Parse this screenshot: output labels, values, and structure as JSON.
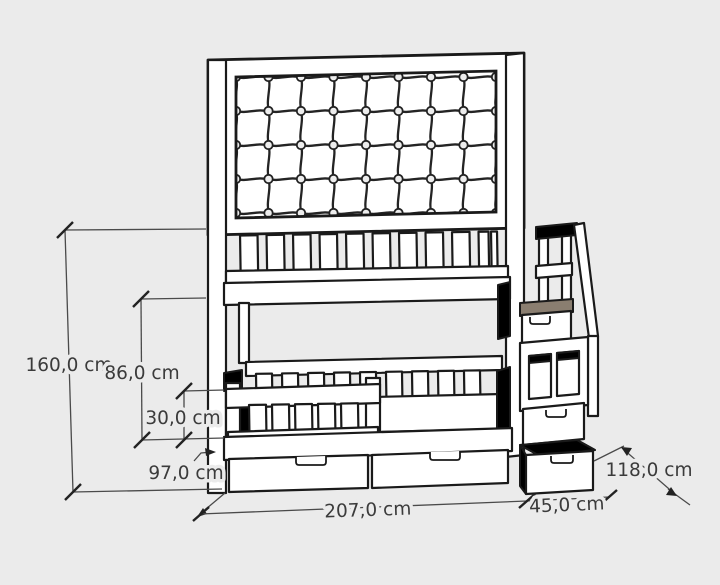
{
  "dims": {
    "total_height": {
      "label": "160,0 cm"
    },
    "upper_bunk_height": {
      "label": "86,0 cm"
    },
    "guardrail_height": {
      "label": "30,0 cm"
    },
    "bed_depth": {
      "label": "97,0 cm"
    },
    "bed_length": {
      "label": "207,0 cm"
    },
    "stairs_width": {
      "label": "45,0 cm"
    },
    "total_depth": {
      "label": "118,0 cm"
    }
  },
  "colors": {
    "background": "#ebebeb",
    "outline": "#1a1a1a",
    "surface_white": "#ffffff",
    "tread_brown": "#8a7e70",
    "tread_brown_dark": "#5e564b",
    "shadow_gray": "#6d6d6d",
    "mattress_gray": "#7a7a7a",
    "dimension_line": "#4a4a4a",
    "dimension_text": "#3b3b3b"
  }
}
